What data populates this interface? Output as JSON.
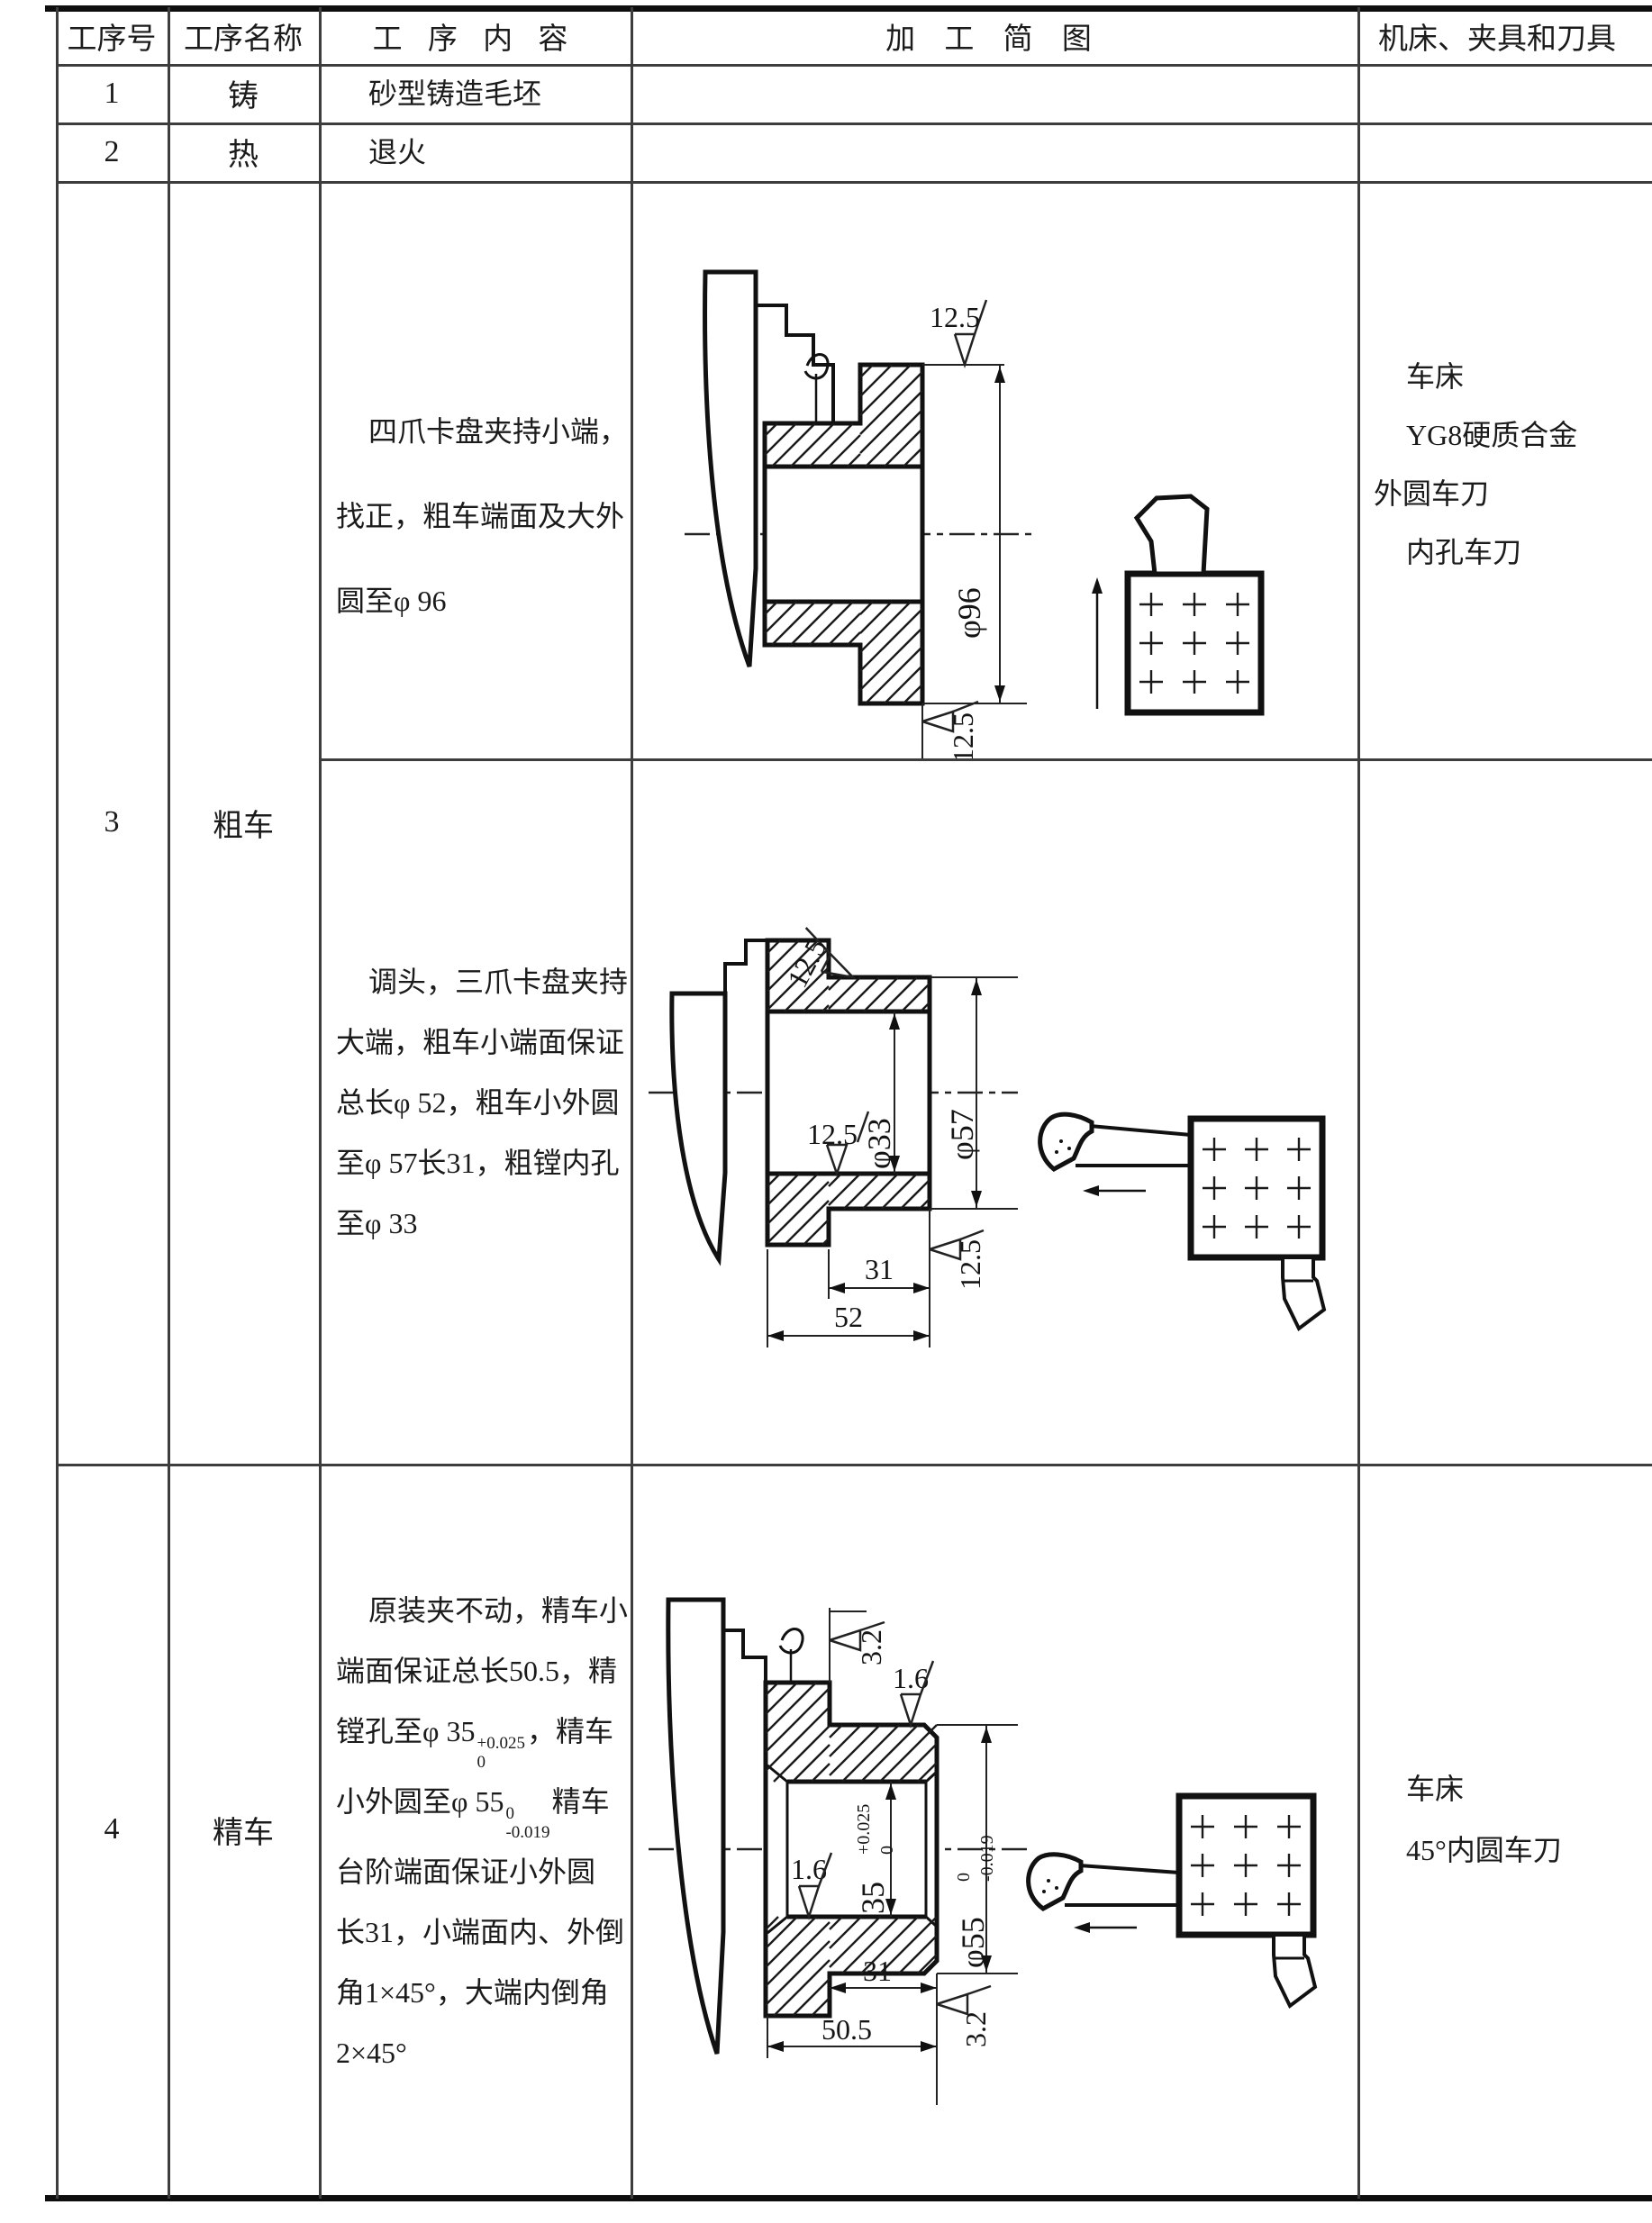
{
  "header": {
    "col1": "工序号",
    "col2": "工序名称",
    "col3": "工 序 内 容",
    "col4": "加 工 简 图",
    "col5": "机床、夹具和刀具"
  },
  "row1": {
    "no": "1",
    "name": "铸",
    "content": "砂型铸造毛坯"
  },
  "row2": {
    "no": "2",
    "name": "热",
    "content": "退火"
  },
  "row3": {
    "no": "3",
    "name": "粗车",
    "op_a_lines": [
      "四爪卡盘夹持小端，",
      "找正，粗车端面及大外",
      "圆至φ 96"
    ],
    "op_b_lines": [
      "调头，三爪卡盘夹持",
      "大端，粗车小端面保证",
      "总长φ 52，粗车小外圆",
      "至φ 57长31，粗镗内孔",
      "至φ 33"
    ],
    "tools_lines": [
      "车床",
      "YG8硬质合金",
      "外圆车刀",
      "内孔车刀"
    ]
  },
  "row4": {
    "no": "4",
    "name": "精车",
    "op_l1": "原装夹不动，精车小",
    "op_l2": "端面保证总长50.5，精",
    "op_l3": {
      "pre": "镗孔至φ 35",
      "sup": "+0.025",
      "sub": "0",
      "post": "，精车"
    },
    "op_l4": {
      "pre": "小外圆至φ 55",
      "sup": "0",
      "sub": "-0.019",
      "post": "精车"
    },
    "op_l5": "台阶端面保证小外圆",
    "op_l6": "长31，小端面内、外倒",
    "op_l7": "角1×45°，大端内倒角",
    "op_l8": "2×45°",
    "tools_lines": [
      "车床",
      "45°内圆车刀"
    ]
  },
  "diagram1": {
    "rough_top": "12.5",
    "dia_large": "φ96",
    "rough_face": "12.5"
  },
  "diagram2": {
    "rough_od": "12.5",
    "dia_bore": "φ33",
    "dia_od": "φ57",
    "rough_bore": "12.5",
    "rough_face": "12.5",
    "len_step": "31",
    "len_total": "52"
  },
  "diagram4": {
    "rough_flange": "3.2",
    "rough_od": "1.6",
    "dia_bore": "35",
    "bore_tol_up": "+0.025",
    "bore_tol_dn": "0",
    "dia_od": "φ55",
    "od_tol_up": "0",
    "od_tol_dn": "-0.019",
    "rough_bore": "1.6",
    "len_step": "31",
    "len_total": "50.5",
    "rough_face": "3.2"
  }
}
